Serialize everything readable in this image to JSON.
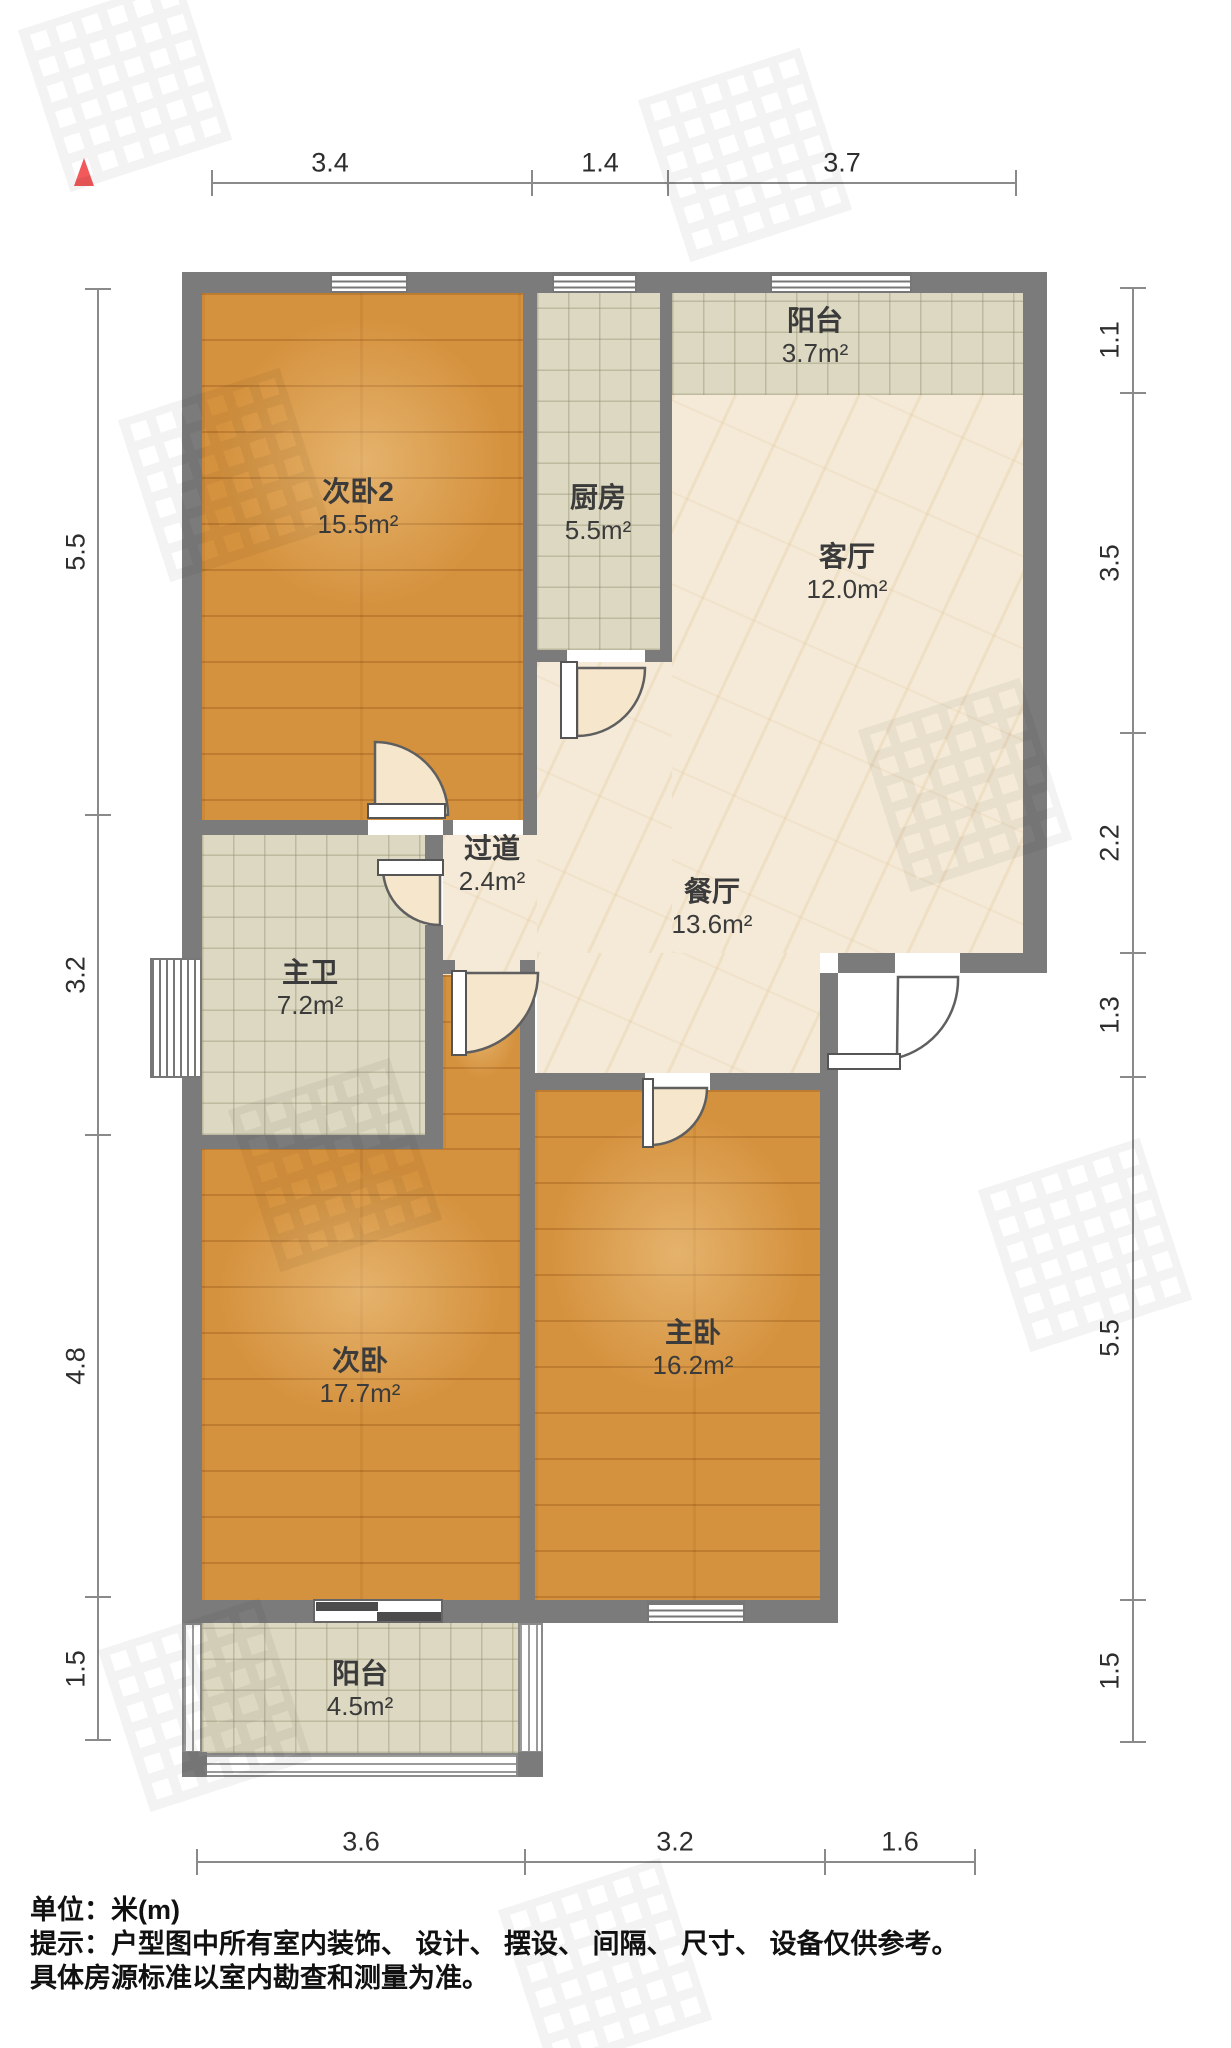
{
  "plan": {
    "title_hint": "apartment floor plan",
    "colors": {
      "wall": "#7b7b7b",
      "wood_floor": "#d5923e",
      "tile_floor": "#dcd8c1",
      "marble_floor": "#f4ead7",
      "dim_line": "#8a8a8a",
      "north_marker": "#f1595a"
    }
  },
  "rooms": [
    {
      "id": "bedroom2",
      "name": "次卧2",
      "area": "15.5m²"
    },
    {
      "id": "kitchen",
      "name": "厨房",
      "area": "5.5m²"
    },
    {
      "id": "balcony-north",
      "name": "阳台",
      "area": "3.7m²"
    },
    {
      "id": "living",
      "name": "客厅",
      "area": "12.0m²"
    },
    {
      "id": "hallway",
      "name": "过道",
      "area": "2.4m²"
    },
    {
      "id": "dining",
      "name": "餐厅",
      "area": "13.6m²"
    },
    {
      "id": "master-bath",
      "name": "主卫",
      "area": "7.2m²"
    },
    {
      "id": "bedroom",
      "name": "次卧",
      "area": "17.7m²"
    },
    {
      "id": "master-bedroom",
      "name": "主卧",
      "area": "16.2m²"
    },
    {
      "id": "balcony-south",
      "name": "阳台",
      "area": "4.5m²"
    }
  ],
  "dims": {
    "top": [
      "3.4",
      "1.4",
      "3.7"
    ],
    "left": [
      "5.5",
      "3.2",
      "4.8",
      "1.5"
    ],
    "right": [
      "1.1",
      "3.5",
      "2.2",
      "1.3",
      "5.5",
      "1.5"
    ],
    "bottom": [
      "3.6",
      "3.2",
      "1.6"
    ]
  },
  "footer": {
    "unit": "单位：米(m)",
    "notice1": "提示：户型图中所有室内装饰、 设计、 摆设、 间隔、 尺寸、 设备仅供参考。",
    "notice2": "具体房源标准以室内勘查和测量为准。"
  }
}
